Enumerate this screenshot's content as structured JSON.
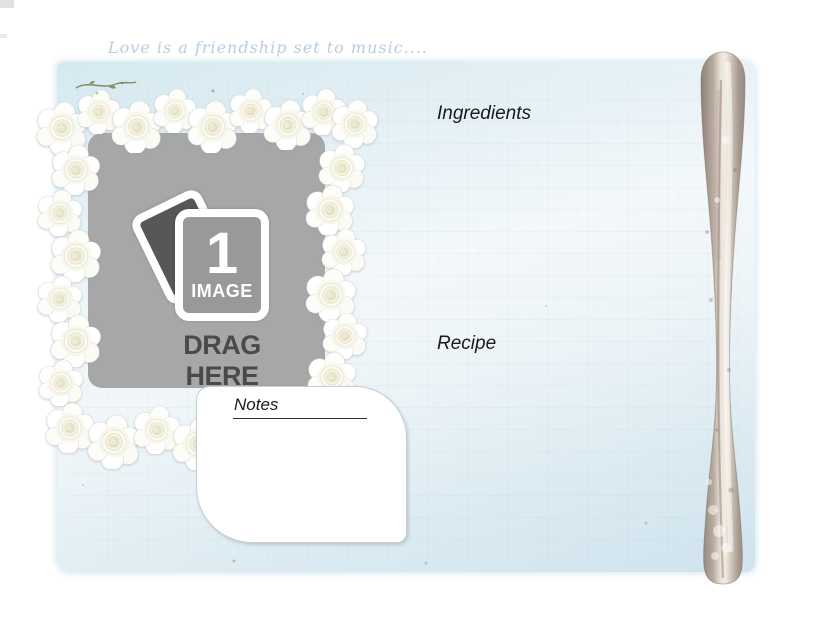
{
  "page": {
    "quote": "Love is a friendship set to music...."
  },
  "photo_drop": {
    "count": "1",
    "count_unit": "IMAGE",
    "instruction": "DRAG HERE"
  },
  "labels": {
    "ingredients": "Ingredients",
    "recipe": "Recipe",
    "notes": "Notes"
  },
  "icons": {
    "frame": "white-rose-frame",
    "drop": "photo-stack-icon",
    "right_edge": "silver-spoon-handle",
    "flourish": "green-leaf-sprig"
  },
  "colors": {
    "page_blue": "#d9eaf2",
    "placeholder_gray": "#a7a7a7",
    "card_back_gray": "#575757",
    "drag_text": "#4a4a4a",
    "quote_blue": "#b9cde0",
    "label_text": "#1b1b1b"
  }
}
